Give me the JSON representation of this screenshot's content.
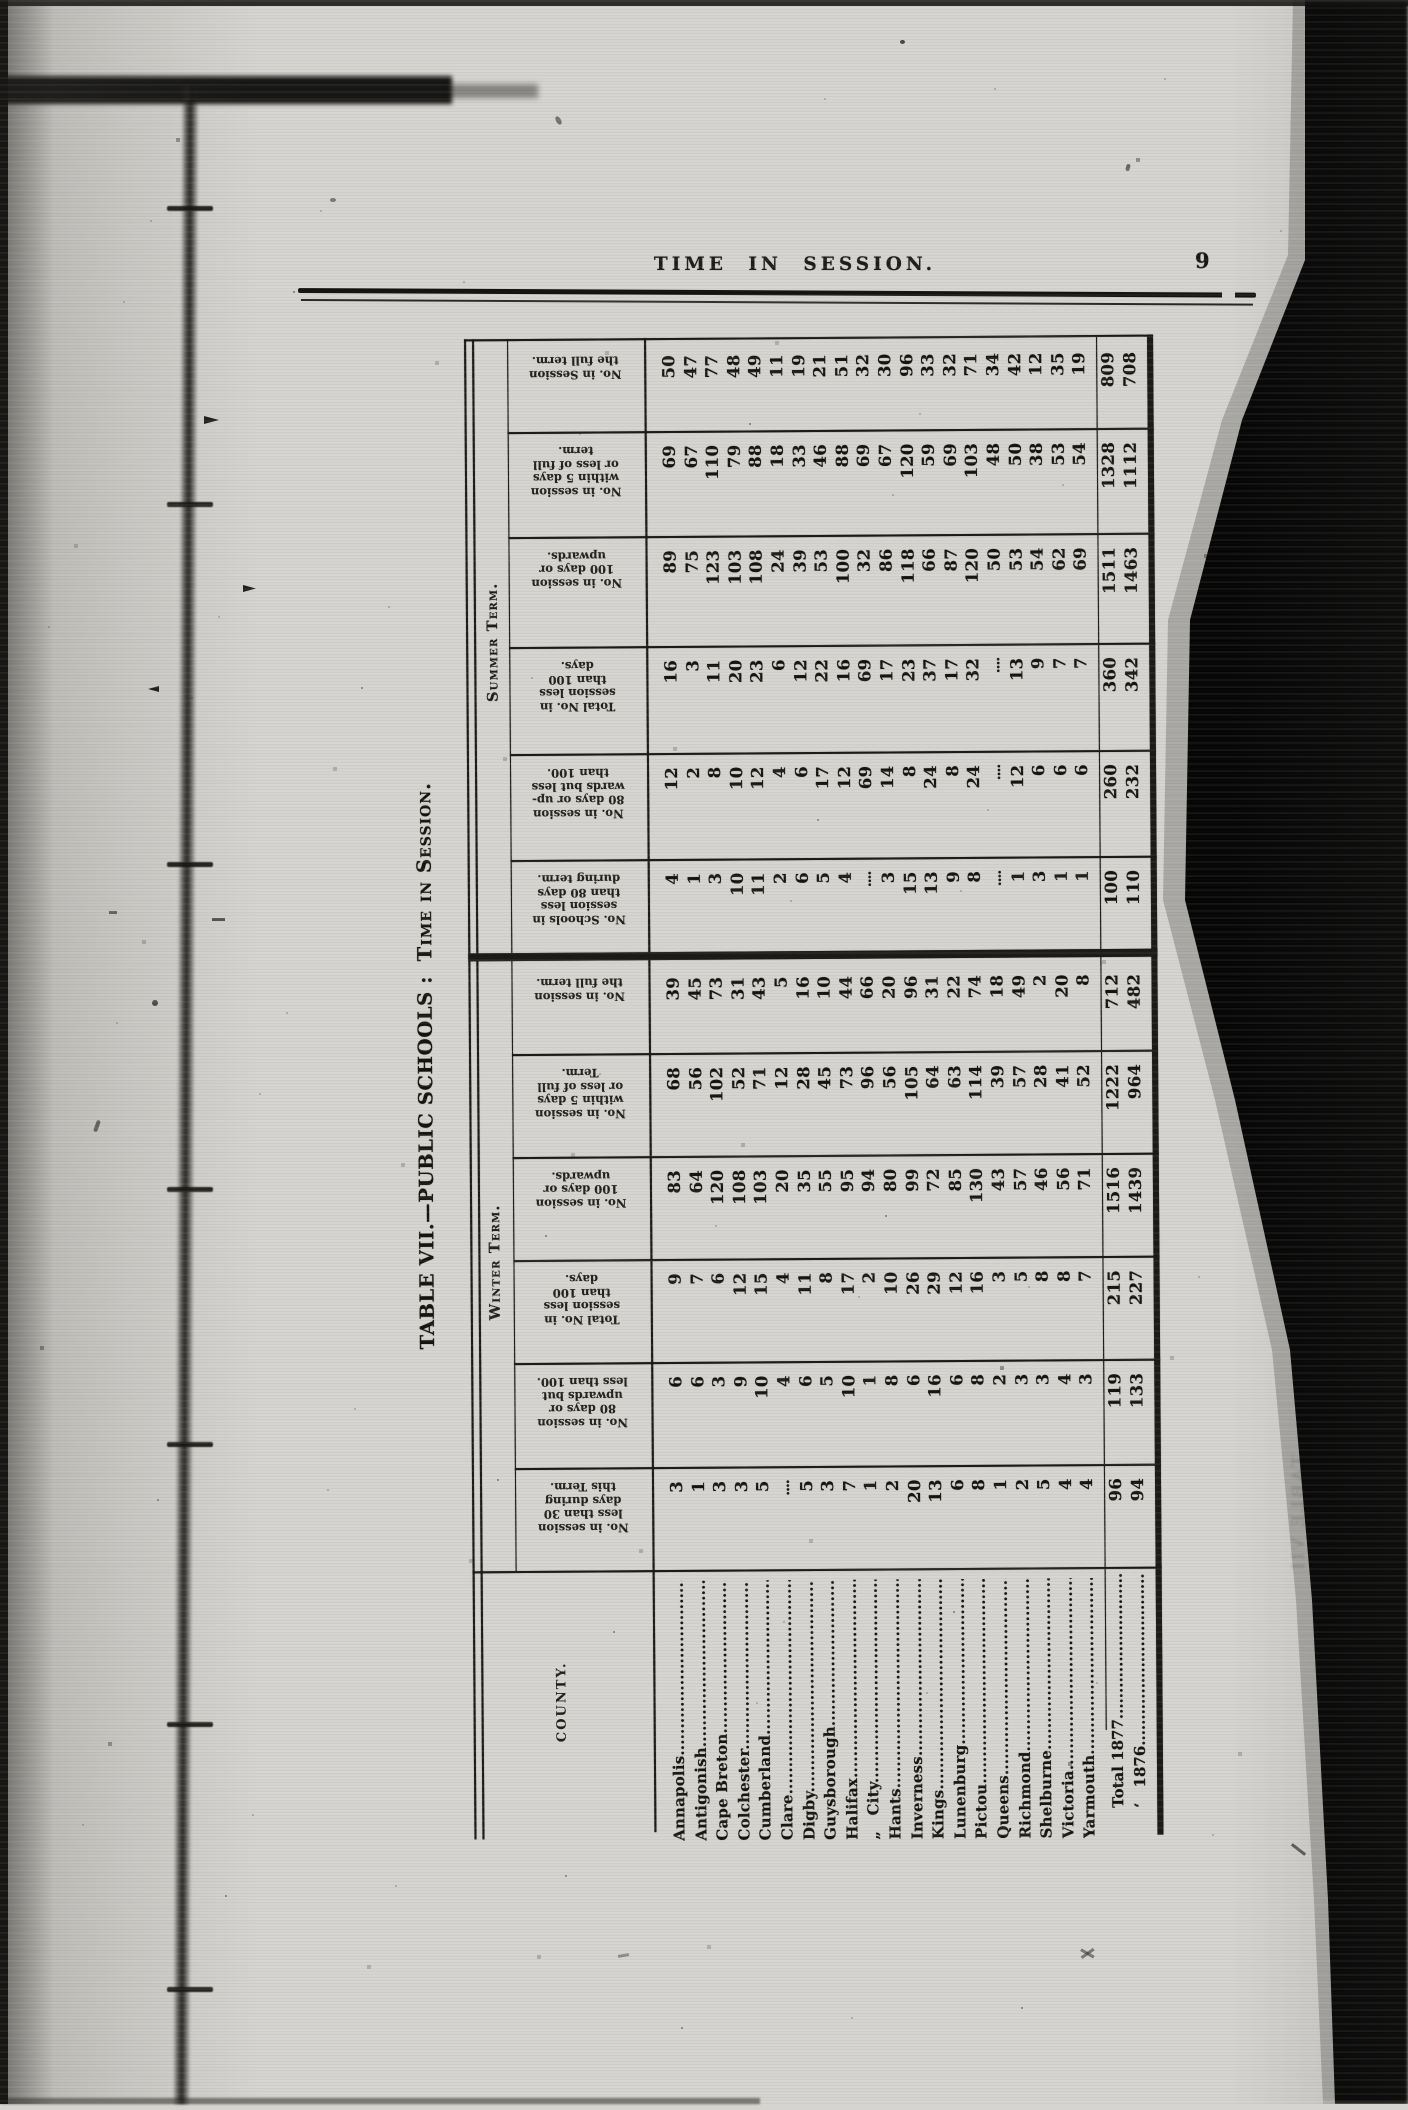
{
  "page": {
    "header": "TIME IN SESSION.",
    "page_number": "9"
  },
  "title": {
    "main": "TABLE VII.—PUBLIC SCHOOLS :",
    "session": "Time in Session."
  },
  "ghost_text": "TABLE VII",
  "table": {
    "county_header": "COUNTY.",
    "groups": [
      {
        "label": "Summer Term."
      },
      {
        "label": "Winter Term."
      }
    ],
    "counties": [
      "Annapolis",
      "Antigonish",
      "Cape Breton",
      "Colchester",
      "Cumberland",
      "Clare",
      "Digby",
      "Guysborough",
      "Halifax",
      "„  City",
      "Hants",
      "Inverness",
      "Kings",
      "Lunenburg",
      "Pictou",
      "Queens",
      "Richmond",
      "Shelburne",
      "Victoria",
      "Yarmouth"
    ],
    "total_row_labels": [
      "Total 1877",
      "‘  1876"
    ],
    "blank_marker": "....",
    "bands": [
      {
        "group": "summer",
        "label_lines": [
          "No. in Session",
          "the full term."
        ],
        "values": [
          "50",
          "47",
          "77",
          "48",
          "49",
          "11",
          "19",
          "21",
          "51",
          "32",
          "30",
          "96",
          "33",
          "32",
          "71",
          "34",
          "42",
          "12",
          "35",
          "19"
        ],
        "totals": [
          "809",
          "708"
        ]
      },
      {
        "group": "summer",
        "label_lines": [
          "No. in session",
          "within 5 days",
          "or less of full",
          "term."
        ],
        "values": [
          "69",
          "67",
          "110",
          "79",
          "88",
          "18",
          "33",
          "46",
          "88",
          "69",
          "67",
          "120",
          "59",
          "69",
          "103",
          "48",
          "50",
          "38",
          "53",
          "54"
        ],
        "totals": [
          "1328",
          "1112"
        ]
      },
      {
        "group": "summer",
        "label_lines": [
          "No. in session",
          "100 days or",
          "upwards."
        ],
        "values": [
          "89",
          "75",
          "123",
          "103",
          "108",
          "24",
          "39",
          "53",
          "100",
          "32",
          "86",
          "118",
          "66",
          "87",
          "120",
          "50",
          "53",
          "54",
          "62",
          "69"
        ],
        "totals": [
          "1511",
          "1463"
        ]
      },
      {
        "group": "summer",
        "label_lines": [
          "Total No. in",
          "session less",
          "than 100",
          "days."
        ],
        "values": [
          "16",
          "3",
          "11",
          "20",
          "23",
          "6",
          "12",
          "22",
          "16",
          "69",
          "17",
          "23",
          "37",
          "17",
          "32",
          "....",
          "13",
          "9",
          "7",
          "7"
        ],
        "totals": [
          "360",
          "342"
        ]
      },
      {
        "group": "summer",
        "label_lines": [
          "No. in session",
          "80 days or up-",
          "wards but less",
          "than 100."
        ],
        "values": [
          "12",
          "2",
          "8",
          "10",
          "12",
          "4",
          "6",
          "17",
          "12",
          "69",
          "14",
          "8",
          "24",
          "8",
          "24",
          "....",
          "12",
          "6",
          "6",
          "6"
        ],
        "totals": [
          "260",
          "232"
        ]
      },
      {
        "group": "summer",
        "label_lines": [
          "No. Schools in",
          "session less",
          "than 80 days",
          "during term."
        ],
        "values": [
          "4",
          "1",
          "3",
          "10",
          "11",
          "2",
          "6",
          "5",
          "4",
          "....",
          "3",
          "15",
          "13",
          "9",
          "8",
          "....",
          "1",
          "3",
          "1",
          "1"
        ],
        "totals": [
          "100",
          "110"
        ]
      },
      {
        "group": "winter",
        "label_lines": [
          "No. in session",
          "the full term."
        ],
        "values": [
          "39",
          "45",
          "73",
          "31",
          "43",
          "5",
          "16",
          "10",
          "44",
          "66",
          "20",
          "96",
          "31",
          "22",
          "74",
          "18",
          "49",
          "2",
          "20",
          "8"
        ],
        "totals": [
          "712",
          "482"
        ]
      },
      {
        "group": "winter",
        "label_lines": [
          "No. in session",
          "within 5 days",
          "or less of full",
          "Term."
        ],
        "values": [
          "68",
          "56",
          "102",
          "52",
          "71",
          "12",
          "28",
          "45",
          "73",
          "96",
          "56",
          "105",
          "64",
          "63",
          "114",
          "39",
          "57",
          "28",
          "41",
          "52"
        ],
        "totals": [
          "1222",
          "964"
        ]
      },
      {
        "group": "winter",
        "label_lines": [
          "No. in session",
          "100 days or",
          "upwards."
        ],
        "values": [
          "83",
          "64",
          "120",
          "108",
          "103",
          "20",
          "35",
          "55",
          "95",
          "94",
          "80",
          "99",
          "72",
          "85",
          "130",
          "43",
          "57",
          "46",
          "56",
          "71"
        ],
        "totals": [
          "1516",
          "1439"
        ]
      },
      {
        "group": "winter",
        "label_lines": [
          "Total No. in",
          "session less",
          "than 100",
          "days."
        ],
        "values": [
          "9",
          "7",
          "6",
          "12",
          "15",
          "4",
          "11",
          "8",
          "17",
          "2",
          "10",
          "26",
          "29",
          "12",
          "16",
          "3",
          "5",
          "8",
          "8",
          "7"
        ],
        "totals": [
          "215",
          "227"
        ]
      },
      {
        "group": "winter",
        "label_lines": [
          "No. in session",
          "80 days or",
          "upwards but",
          "less than 100."
        ],
        "values": [
          "6",
          "6",
          "3",
          "9",
          "10",
          "4",
          "6",
          "5",
          "10",
          "1",
          "8",
          "6",
          "16",
          "6",
          "8",
          "2",
          "3",
          "3",
          "4",
          "3"
        ],
        "totals": [
          "119",
          "133"
        ]
      },
      {
        "group": "winter",
        "label_lines": [
          "No. in session",
          "less than 30",
          "days during",
          "this Term."
        ],
        "values": [
          "3",
          "1",
          "3",
          "3",
          "5",
          "....",
          "5",
          "3",
          "7",
          "1",
          "2",
          "20",
          "13",
          "6",
          "8",
          "1",
          "2",
          "5",
          "4",
          "4"
        ],
        "totals": [
          "96",
          "94"
        ]
      }
    ]
  }
}
